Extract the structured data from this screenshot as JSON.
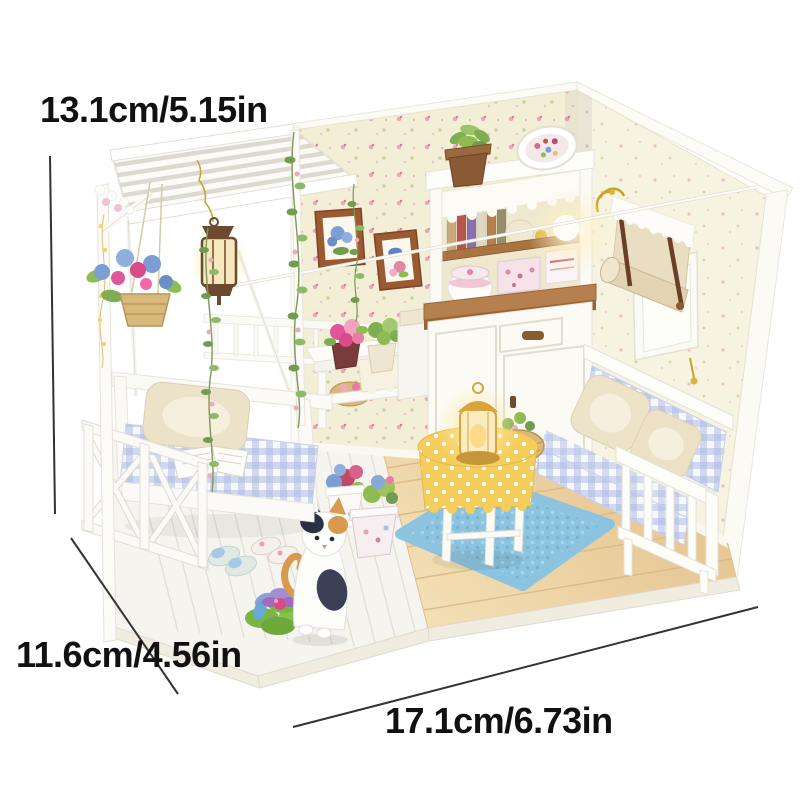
{
  "image": {
    "alt": "DIY miniature dollhouse room with pergola porch, swing, sofa, hutch cabinet, cat figurine and furniture, annotated with product dimensions"
  },
  "dimensions": {
    "height_label": "13.1cm/5.15in",
    "depth_label": "11.6cm/4.56in",
    "width_label": "17.1cm/6.73in"
  },
  "palette": {
    "background": "#ffffff",
    "dimension_line": "#333333",
    "label_text": "#111111",
    "wall_back": "#f3eed6",
    "wall_right": "#f7f3e1",
    "floor_wood": "#ecd2a2",
    "porch_floor": "#f6f4ee",
    "furniture_white": "#fbfaf7",
    "gingham_blue": "#a9b8e2",
    "rug_blue": "#8cc3de",
    "tablecloth_yellow": "#f4cd5c",
    "counter_wood": "#b5804d",
    "frame_brown": "#9c5a32",
    "lantern_glow": "#ffe9a8",
    "cat_orange": "#d99a4e",
    "leaf_green": "#6f9c4f"
  },
  "scene_objects": [
    "pergola-roof",
    "porch-swing",
    "porch-railing",
    "hanging-lantern",
    "hanging-flower-basket",
    "vines",
    "picture-frames",
    "wall-plate",
    "hutch-cabinet",
    "potted-plant",
    "window",
    "roman-shade",
    "string-light",
    "sofa",
    "throw-pillows",
    "round-table",
    "table-lantern",
    "woven-basket",
    "blue-rug",
    "flower-pots",
    "lotus-flower",
    "calico-cat",
    "slippers",
    "plant-shelf"
  ]
}
